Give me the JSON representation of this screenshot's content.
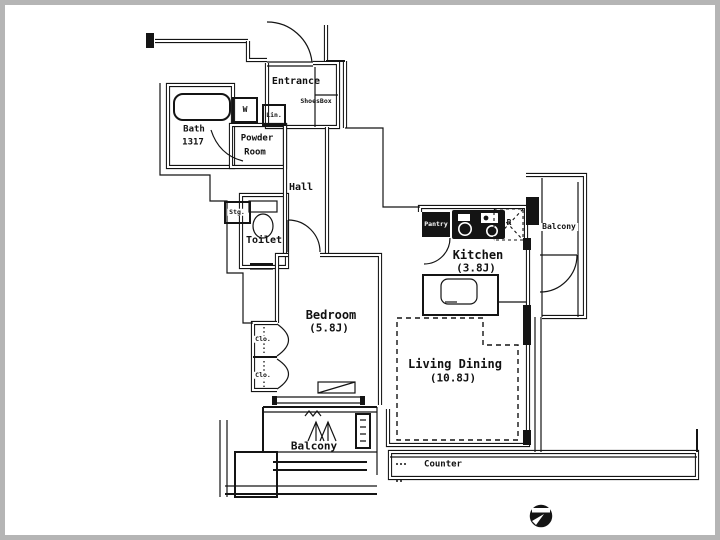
{
  "plan": {
    "labels": {
      "entrance": "Entrance",
      "shoesbox": "ShoesBox",
      "bath": "Bath",
      "bath_size": "1317",
      "washer": "W",
      "linen": "Lin.",
      "powder_line1": "Powder",
      "powder_line2": "Room",
      "hall": "Hall",
      "storage": "Stg.",
      "toilet": "Toilet",
      "pantry": "Pantry",
      "fridge": "R",
      "kitchen": "Kitchen",
      "kitchen_size": "(3.8J)",
      "balcony_right": "Balcony",
      "bedroom": "Bedroom",
      "bedroom_size": "(5.8J)",
      "living_dining": "Living Dining",
      "living_dining_size": "(10.8J)",
      "closet_upper": "Clo.",
      "closet_lower": "Clo.",
      "balcony_bottom": "Balcony",
      "counter": "Counter"
    },
    "colors": {
      "wall": "#141414",
      "background": "#ffffff",
      "frame": "#b5b5b5"
    }
  }
}
